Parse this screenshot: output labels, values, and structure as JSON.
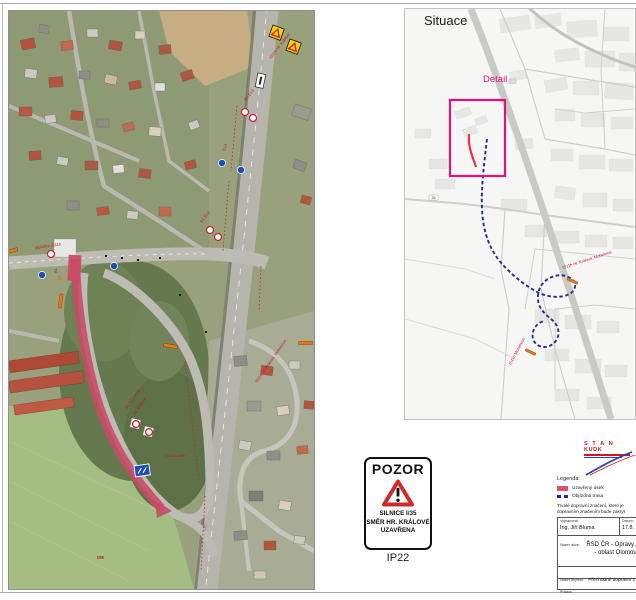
{
  "right_map": {
    "title": "Situace",
    "detail_label": "Detail",
    "marker_label_top": "IS11b Hr. Králové, Mohelnice",
    "marker_label_bottom": "IS11b Mohelnice",
    "route_shield": "35"
  },
  "left_map": {
    "labels": [
      "IS11b Hr. Králové",
      "B1 E13",
      "E13",
      "B1 E13",
      "objížďka IS11b",
      "B1",
      "B1 E13 směr",
      "Hr. Králové",
      "0,120 d. 40m",
      "IS11b Hr. Králové, Mohelnice",
      "IS8",
      "I/35"
    ]
  },
  "pozor_sign": {
    "title": "POZOR",
    "line1": "SILNICE I/35",
    "line2": "SMĚR HR. KRÁLOVÉ",
    "line3": "UZAVŘENA",
    "code": "IP22"
  },
  "legend": {
    "title": "Legenda:",
    "items": [
      {
        "label": "Uzavřený úsek"
      },
      {
        "label": "Objízdná trasa"
      }
    ],
    "note_line1": "Trvalé dopravní značení, které je",
    "note_line2": "dopravním značením bude zakryt"
  },
  "title_block": {
    "author_label": "Vypracoval:",
    "author": "Ing. Jiří Bluma",
    "date_label": "Datum:",
    "date": "17.8.",
    "action_label": "Název akce:",
    "action_line1": "ŘSD ČR - Opravy AHV",
    "action_line2": "- oblast Olomouc",
    "object_label": "Název objektu:",
    "object_value": "Přechodné dopravní z",
    "attachment_label": "Příloha:",
    "footer_note": "IZb verze 8"
  },
  "logo": {
    "line1": "S T A N",
    "line2": "KUDK"
  },
  "colors": {
    "closure": "#c94a66",
    "closure_bright": "#e8323c",
    "detour_blue": "#2b2b8f",
    "detail_pink": "#e3117e",
    "legend_red": "#e8506a",
    "marker_orange": "#e67817"
  }
}
